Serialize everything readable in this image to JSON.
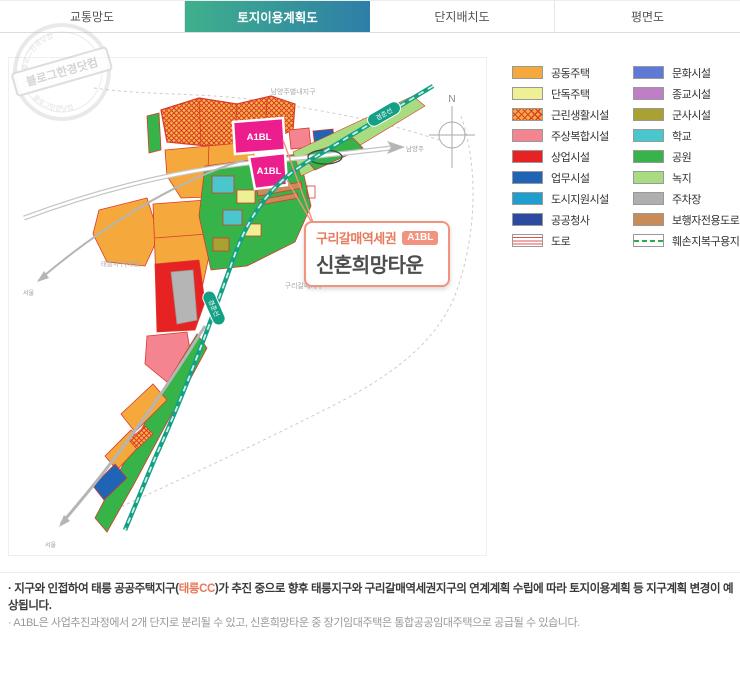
{
  "tabs": [
    {
      "label": "교통망도"
    },
    {
      "label": "토지이용계획도"
    },
    {
      "label": "단지배치도"
    },
    {
      "label": "평면도"
    }
  ],
  "active_tab_index": 1,
  "watermark": {
    "text": "블로그한경닷컴"
  },
  "map": {
    "compass": "N",
    "a1bl_label": "A1BL",
    "rail_label": "경춘선",
    "labels": {
      "top_district": "남양주별내지구",
      "bottom_district": "구리갈매지구",
      "left_district": "태릉지구(예정)",
      "right_city": "남양주",
      "seoul": "서울"
    }
  },
  "callout": {
    "line1": "구리갈매역세권",
    "badge": "A1BL",
    "line2": "신혼희망타운"
  },
  "legend": {
    "col1": [
      {
        "label": "공동주택",
        "style": "background:#F5A93C"
      },
      {
        "label": "단독주택",
        "style": "background:#EFF096"
      },
      {
        "label": "근린생활시설",
        "style": "background:repeating-linear-gradient(45deg,rgba(217,58,43,0.95) 0 1.4px,rgba(0,0,0,0) 1.4px 4.6px),repeating-linear-gradient(135deg,rgba(217,58,43,0.95) 0 1.4px,rgba(0,0,0,0) 1.4px 4.6px),#F7AA3D"
      },
      {
        "label": "주상복합시설",
        "style": "background:#F4848F"
      },
      {
        "label": "상업시설",
        "style": "background:#E62222"
      },
      {
        "label": "업무시설",
        "style": "background:#2065B5"
      },
      {
        "label": "도시지원시설",
        "style": "background:#1E9FD0"
      },
      {
        "label": "공공청사",
        "style": "background:#2A4BA0"
      },
      {
        "label": "도로",
        "style": "background:repeating-linear-gradient(180deg,#FFFFFF 0 2.2px,#E05050 2.2px 3.2px),#FFFFFF"
      }
    ],
    "col2": [
      {
        "label": "문화시설",
        "style": "background:#5E79D6"
      },
      {
        "label": "종교시설",
        "style": "background:#BE7FC6"
      },
      {
        "label": "군사시설",
        "style": "background:#A9A233"
      },
      {
        "label": "학교",
        "style": "background:#4AC7CD"
      },
      {
        "label": "공원",
        "style": "background:#36B44A"
      },
      {
        "label": "녹지",
        "style": "background:#A9DB80"
      },
      {
        "label": "주차장",
        "style": "background:#AFAFAF"
      },
      {
        "label": "보행자전용도로",
        "style": "background:#C98C59"
      },
      {
        "label": "훼손지복구용지",
        "style": "background:repeating-linear-gradient(90deg,#2FA84F 0 5px,#FFFFFF 5px 8px) center/100% 2px no-repeat,#FFFFFF"
      }
    ]
  },
  "notes": {
    "line1_pre": "· 지구와 인접하여 태릉 공공주택지구(",
    "line1_em": "태릉CC",
    "line1_post": ")가 추진 중으로 향후 태릉지구와 구리갈매역세권지구의 연계계획 수립에 따라 토지이용계획 등 지구계획 변경이 예상됩니다.",
    "line2": "· A1BL은 사업추진과정에서 2개 단지로 분리될 수 있고, 신혼희망타운 중 장기임대주택은 통합공공임대주택으로 공급될 수 있습니다."
  },
  "colors": {
    "accent_teal_from": "#3FB08C",
    "accent_teal_to": "#2E7EA8",
    "callout_accent": "#F2937F",
    "rail": "#14A085",
    "a1bl_magenta": "#EC1E8E"
  }
}
